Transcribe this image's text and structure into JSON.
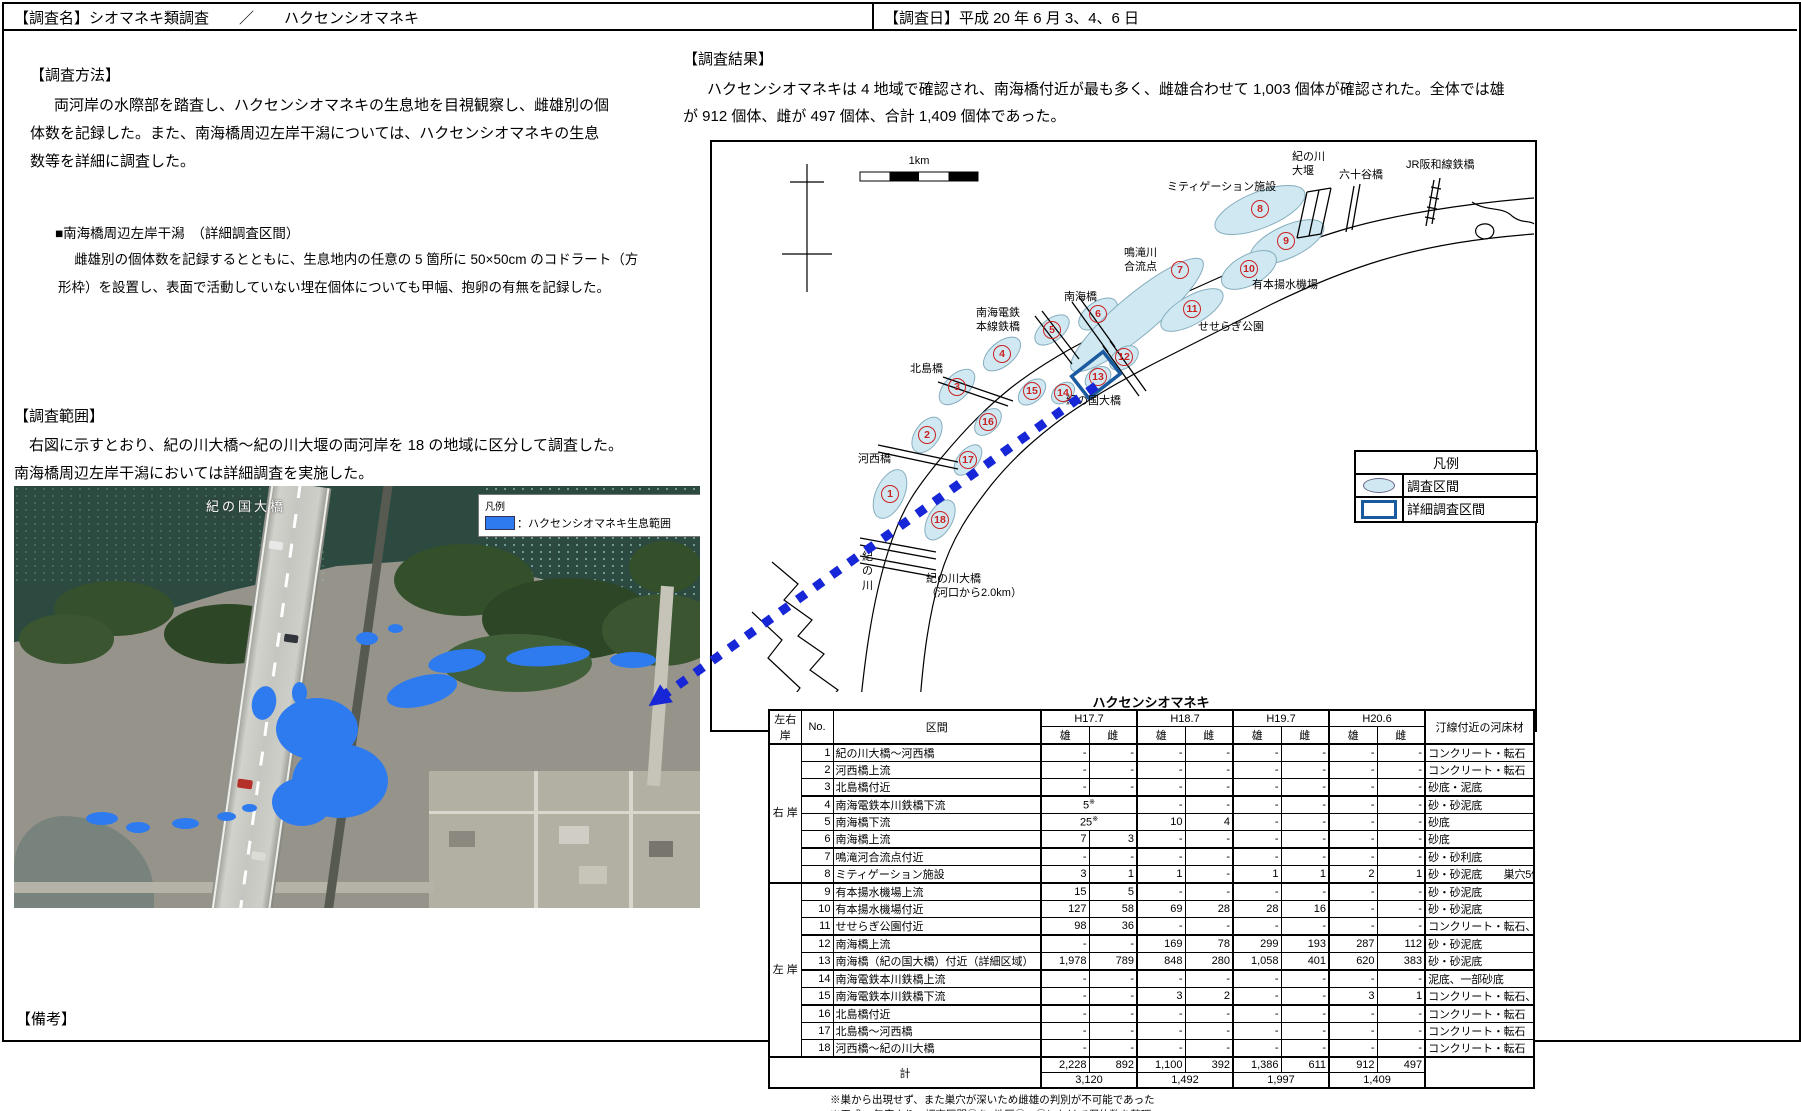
{
  "header": {
    "survey_name": "【調査名】シオマネキ類調査　　／　　ハクセンシオマネキ",
    "survey_date": "【調査日】平成 20 年 6 月 3、4、6 日"
  },
  "method": {
    "title": "【調査方法】",
    "body": "両河岸の水際部を踏査し、ハクセンシオマネキの生息地を目視観察し、雌雄別の個\n体数を記録した。また、南海橋周辺左岸干潟については、ハクセンシオマネキの生息\n数等を詳細に調査した。",
    "sub_title": "■南海橋周辺左岸干潟　（詳細調査区間）",
    "sub_body": "雌雄別の個体数を記録するとともに、生息地内の任意の 5 箇所に 50×50cm のコドラート（方\n形枠）を設置し、表面で活動していない埋在個体についても甲幅、抱卵の有無を記録した。"
  },
  "range": {
    "title": "【調査範囲】",
    "body": "右図に示すとおり、紀の川大橋〜紀の川大堰の両河岸を 18 の地域に区分して調査した。\n南海橋周辺左岸干潟においては詳細調査を実施した。"
  },
  "results": {
    "title": "【調査結果】",
    "body": "ハクセンシオマネキは 4 地域で確認され、南海橋付近が最も多く、雌雄合わせて 1,003 個体が確認された。全体では雄\nが 912 個体、雌が 497 個体、合計 1,409 個体であった。"
  },
  "remarks": {
    "title": "【備考】"
  },
  "photo": {
    "bridge_label": "紀の国大橋",
    "legend_title": "凡例",
    "legend_item": "：ハクセンシオマネキ生息範囲",
    "habitat_color": "#2e7bf0"
  },
  "map": {
    "scale_label": "1km",
    "legend": {
      "title": "凡例",
      "survey": "調査区間",
      "detail": "詳細調査区間"
    },
    "zone_fill": "#cfe8f2",
    "number_color": "#cc2222",
    "detail_box_color": "#1a5a9e",
    "arrow_color": "#1726d6",
    "labels": [
      {
        "t": "1km",
        "x": 207,
        "y": 12,
        "cls": "c"
      },
      {
        "t": "ミティゲーション施設",
        "x": 455,
        "y": 38
      },
      {
        "t": "紀の川\n大堰",
        "x": 580,
        "y": 8
      },
      {
        "t": "六十谷橋",
        "x": 627,
        "y": 26
      },
      {
        "t": "JR阪和線鉄橋",
        "x": 694,
        "y": 16
      },
      {
        "t": "鳴滝川\n合流点",
        "x": 412,
        "y": 104
      },
      {
        "t": "有本揚水機場",
        "x": 540,
        "y": 136
      },
      {
        "t": "南海橋",
        "x": 352,
        "y": 148
      },
      {
        "t": "南海電鉄\n本線鉄橋",
        "x": 264,
        "y": 164
      },
      {
        "t": "せせらぎ公園",
        "x": 486,
        "y": 178
      },
      {
        "t": "北島橋",
        "x": 198,
        "y": 220
      },
      {
        "t": "河西橋",
        "x": 146,
        "y": 310
      },
      {
        "t": "紀の国大橋",
        "x": 354,
        "y": 252
      },
      {
        "t": "紀の川大橋\n（河口から2.0km）",
        "x": 214,
        "y": 430
      },
      {
        "t": "紀\nの\n川",
        "x": 150,
        "y": 408
      }
    ],
    "zones": [
      {
        "cx": 178,
        "cy": 352,
        "rx": 26,
        "ry": 14,
        "rot": -65
      },
      {
        "cx": 215,
        "cy": 293,
        "rx": 20,
        "ry": 12,
        "rot": -55
      },
      {
        "cx": 245,
        "cy": 245,
        "rx": 22,
        "ry": 12,
        "rot": -45
      },
      {
        "cx": 290,
        "cy": 212,
        "rx": 22,
        "ry": 12,
        "rot": -40
      },
      {
        "cx": 340,
        "cy": 188,
        "rx": 20,
        "ry": 11,
        "rot": -38
      },
      {
        "cx": 386,
        "cy": 172,
        "rx": 22,
        "ry": 12,
        "rot": -35
      },
      {
        "cx": 425,
        "cy": 173,
        "rx": 85,
        "ry": 20,
        "rot": -40
      },
      {
        "cx": 548,
        "cy": 68,
        "rx": 48,
        "ry": 18,
        "rot": -22
      },
      {
        "cx": 575,
        "cy": 100,
        "rx": 40,
        "ry": 16,
        "rot": -25
      },
      {
        "cx": 537,
        "cy": 128,
        "rx": 30,
        "ry": 15,
        "rot": -28
      },
      {
        "cx": 480,
        "cy": 168,
        "rx": 35,
        "ry": 14,
        "rot": -30
      },
      {
        "cx": 412,
        "cy": 216,
        "rx": 16,
        "ry": 10,
        "rot": -35
      },
      {
        "cx": 386,
        "cy": 236,
        "rx": 14,
        "ry": 10,
        "rot": -35
      },
      {
        "cx": 351,
        "cy": 251,
        "rx": 13,
        "ry": 9,
        "rot": -40
      },
      {
        "cx": 320,
        "cy": 250,
        "rx": 16,
        "ry": 10,
        "rot": -42
      },
      {
        "cx": 276,
        "cy": 280,
        "rx": 16,
        "ry": 10,
        "rot": -45
      },
      {
        "cx": 256,
        "cy": 318,
        "rx": 18,
        "ry": 10,
        "rot": -50
      },
      {
        "cx": 228,
        "cy": 378,
        "rx": 22,
        "ry": 12,
        "rot": -60
      }
    ],
    "numbers": [
      {
        "n": "1",
        "x": 178,
        "y": 352
      },
      {
        "n": "2",
        "x": 215,
        "y": 293
      },
      {
        "n": "3",
        "x": 245,
        "y": 245
      },
      {
        "n": "4",
        "x": 290,
        "y": 212
      },
      {
        "n": "5",
        "x": 340,
        "y": 188
      },
      {
        "n": "6",
        "x": 386,
        "y": 172
      },
      {
        "n": "7",
        "x": 468,
        "y": 128
      },
      {
        "n": "8",
        "x": 548,
        "y": 67
      },
      {
        "n": "9",
        "x": 574,
        "y": 99
      },
      {
        "n": "10",
        "x": 537,
        "y": 127
      },
      {
        "n": "11",
        "x": 480,
        "y": 167
      },
      {
        "n": "12",
        "x": 412,
        "y": 215
      },
      {
        "n": "13",
        "x": 386,
        "y": 235
      },
      {
        "n": "14",
        "x": 351,
        "y": 251
      },
      {
        "n": "15",
        "x": 320,
        "y": 249
      },
      {
        "n": "16",
        "x": 276,
        "y": 280
      },
      {
        "n": "17",
        "x": 256,
        "y": 318
      },
      {
        "n": "18",
        "x": 228,
        "y": 378
      }
    ]
  },
  "table": {
    "title": "ハクセンシオマネキ",
    "col_bank": "左右\n岸",
    "col_no": "No.",
    "col_section": "区間",
    "col_groups": [
      "H17.7",
      "H18.7",
      "H19.7",
      "H20.6"
    ],
    "col_male": "雄",
    "col_female": "雌",
    "col_substrate": "汀線付近の河床材",
    "bank_right": "右\n岸",
    "bank_left": "左\n岸",
    "rows": [
      {
        "no": "1",
        "section": "紀の川大橋〜河西橋",
        "cells": [
          "-",
          "-",
          "-",
          "-",
          "-",
          "-",
          "-",
          "-"
        ],
        "substrate": "コンクリート・転石"
      },
      {
        "no": "2",
        "section": "河西橋上流",
        "cells": [
          "-",
          "-",
          "-",
          "-",
          "-",
          "-",
          "-",
          "-"
        ],
        "substrate": "コンクリート・転石"
      },
      {
        "no": "3",
        "section": "北島橋付近",
        "cells": [
          "-",
          "-",
          "-",
          "-",
          "-",
          "-",
          "-",
          "-"
        ],
        "substrate": "砂底・泥底"
      },
      {
        "no": "4",
        "section": "南海電鉄本川鉄橋下流",
        "cells": [
          {
            "v": "5",
            "sup": "※",
            "span": 2
          },
          "-",
          "-",
          "-",
          "-",
          "-",
          "-"
        ],
        "substrate": "砂・砂泥底",
        "thick": true
      },
      {
        "no": "5",
        "section": "南海橋下流",
        "cells": [
          {
            "v": "25",
            "sup": "※",
            "span": 2
          },
          "10",
          "4",
          "-",
          "-",
          "-",
          "-"
        ],
        "substrate": "砂底"
      },
      {
        "no": "6",
        "section": "南海橋上流",
        "cells": [
          "7",
          "3",
          "-",
          "-",
          "-",
          "-",
          "-",
          "-"
        ],
        "substrate": "砂底"
      },
      {
        "no": "7",
        "section": "鳴滝河合流点付近",
        "cells": [
          "-",
          "-",
          "-",
          "-",
          "-",
          "-",
          "-",
          "-"
        ],
        "substrate": "砂・砂利底",
        "thick": true
      },
      {
        "no": "8",
        "section": "ミティゲーション施設",
        "cells": [
          "3",
          "1",
          "1",
          "-",
          "1",
          "1",
          "2",
          "1"
        ],
        "substrate": "砂・砂泥底　　巣穴5個確認"
      },
      {
        "no": "9",
        "section": "有本揚水機場上流",
        "cells": [
          "15",
          "5",
          "-",
          "-",
          "-",
          "-",
          "-",
          "-"
        ],
        "substrate": "砂・砂泥底",
        "thick": true
      },
      {
        "no": "10",
        "section": "有本揚水機場付近",
        "cells": [
          "127",
          "58",
          "69",
          "28",
          "28",
          "16",
          "-",
          "-"
        ],
        "substrate": "砂・砂泥底"
      },
      {
        "no": "11",
        "section": "せせらぎ公園付近",
        "cells": [
          "98",
          "36",
          "-",
          "-",
          "-",
          "-",
          "-",
          "-"
        ],
        "substrate": "コンクリート・転石、一部砂底"
      },
      {
        "no": "12",
        "section": "南海橋上流",
        "cells": [
          "-",
          "-",
          "169",
          "78",
          "299",
          "193",
          "287",
          "112"
        ],
        "substrate": "砂・砂泥底",
        "thick": true
      },
      {
        "no": "13",
        "section": "南海橋（紀の国大橋）付近（詳細区域）",
        "cells": [
          "1,978",
          "789",
          "848",
          "280",
          "1,058",
          "401",
          "620",
          "383"
        ],
        "substrate": "砂・砂泥底"
      },
      {
        "no": "14",
        "section": "南海電鉄本川鉄橋上流",
        "cells": [
          "-",
          "-",
          "-",
          "-",
          "-",
          "-",
          "-",
          "-"
        ],
        "substrate": "泥底、一部砂底",
        "thick": true
      },
      {
        "no": "15",
        "section": "南海電鉄本川鉄橋下流",
        "cells": [
          "-",
          "-",
          "3",
          "2",
          "-",
          "-",
          "3",
          "1"
        ],
        "substrate": "コンクリート・転石、一部砂底"
      },
      {
        "no": "16",
        "section": "北島橋付近",
        "cells": [
          "-",
          "-",
          "-",
          "-",
          "-",
          "-",
          "-",
          "-"
        ],
        "substrate": "コンクリート・転石",
        "thick": true
      },
      {
        "no": "17",
        "section": "北島橋〜河西橋",
        "cells": [
          "-",
          "-",
          "-",
          "-",
          "-",
          "-",
          "-",
          "-"
        ],
        "substrate": "コンクリート・転石"
      },
      {
        "no": "18",
        "section": "河西橋〜紀の川大橋",
        "cells": [
          "-",
          "-",
          "-",
          "-",
          "-",
          "-",
          "-",
          "-"
        ],
        "substrate": "コンクリート・転石"
      }
    ],
    "total_label": "計",
    "totals": [
      "2,228",
      "892",
      "1,100",
      "392",
      "1,386",
      "611",
      "912",
      "497"
    ],
    "totals_combined": [
      "3,120",
      "1,492",
      "1,997",
      "1,409"
    ],
    "notes": [
      "※巣から出現せず、また巣穴が深いため雌雄の判別が不可能であった",
      "※平成18年度より、調査区間⑬を2地区⑫、⑬にわけて個体数を整理。"
    ]
  }
}
